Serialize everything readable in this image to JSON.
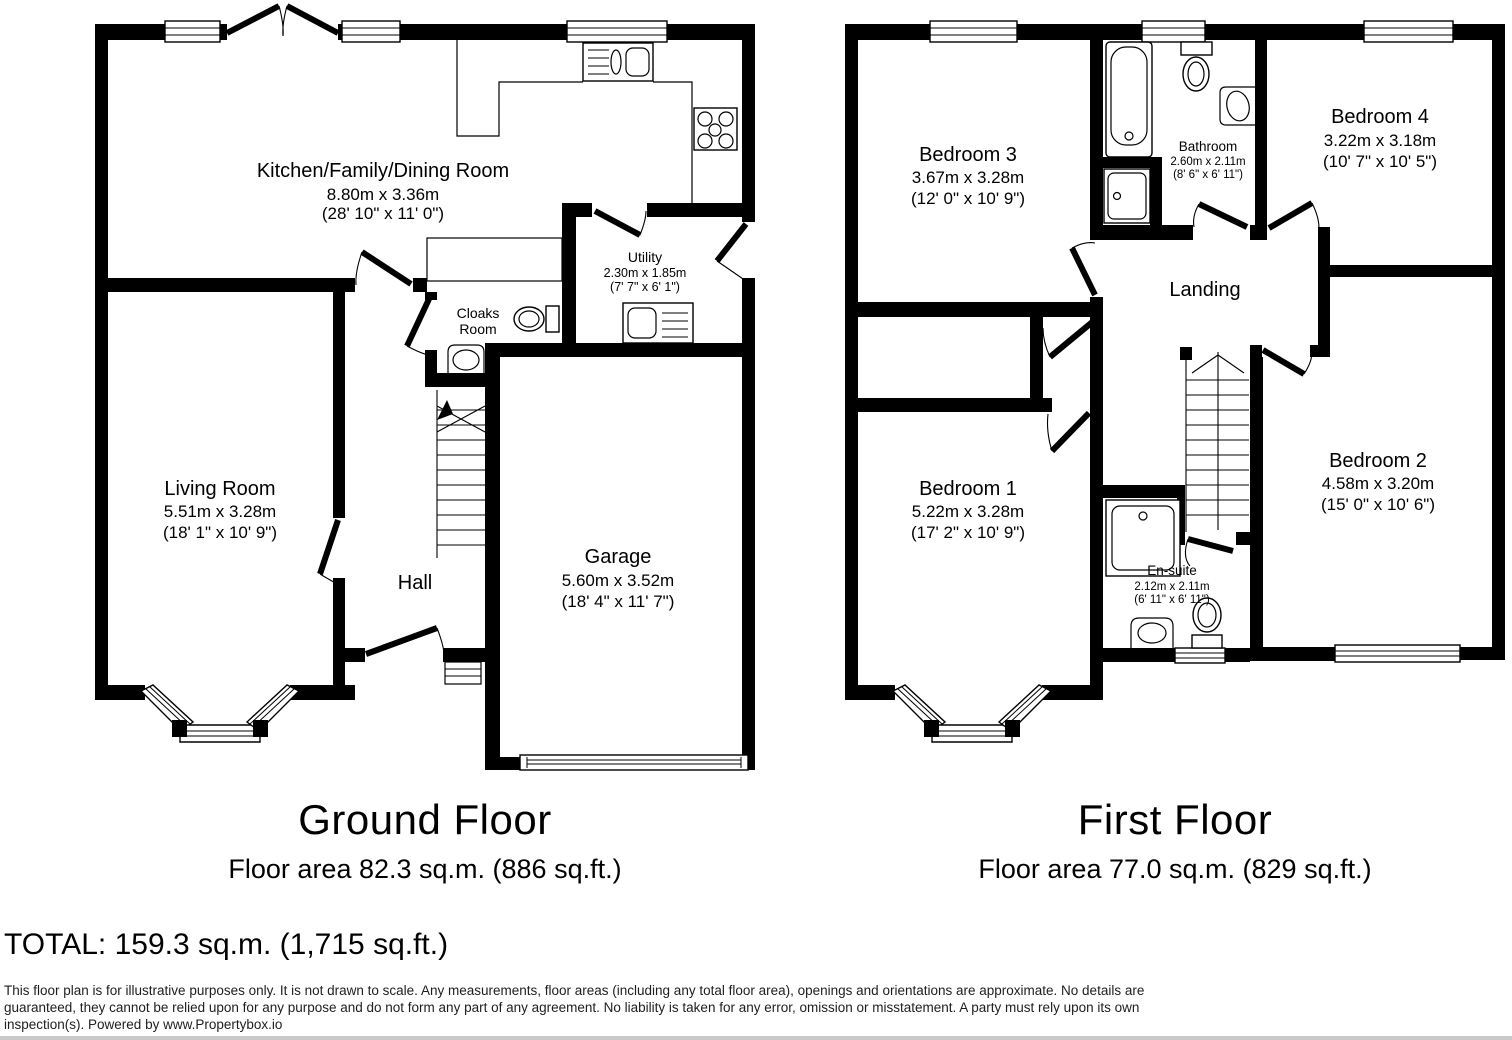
{
  "ground": {
    "title": "Ground Floor",
    "area": "Floor area 82.3 sq.m. (886 sq.ft.)",
    "rooms": {
      "kitchen": {
        "name": "Kitchen/Family/Dining Room",
        "metric": "8.80m x 3.36m",
        "imperial": "(28' 10\" x 11' 0\")"
      },
      "living": {
        "name": "Living Room",
        "metric": "5.51m x 3.28m",
        "imperial": "(18' 1\" x 10' 9\")"
      },
      "hall": {
        "name": "Hall"
      },
      "garage": {
        "name": "Garage",
        "metric": "5.60m x 3.52m",
        "imperial": "(18' 4\" x 11' 7\")"
      },
      "utility": {
        "name": "Utility",
        "metric": "2.30m x 1.85m",
        "imperial": "(7' 7\" x 6' 1\")"
      },
      "cloaks": {
        "line1": "Cloaks",
        "line2": "Room"
      }
    }
  },
  "first": {
    "title": "First Floor",
    "area": "Floor area 77.0 sq.m. (829 sq.ft.)",
    "rooms": {
      "bed1": {
        "name": "Bedroom 1",
        "metric": "5.22m x 3.28m",
        "imperial": "(17' 2\" x 10' 9\")"
      },
      "bed2": {
        "name": "Bedroom 2",
        "metric": "4.58m x 3.20m",
        "imperial": "(15' 0\" x 10' 6\")"
      },
      "bed3": {
        "name": "Bedroom 3",
        "metric": "3.67m x 3.28m",
        "imperial": "(12' 0\" x 10' 9\")"
      },
      "bed4": {
        "name": "Bedroom 4",
        "metric": "3.22m x 3.18m",
        "imperial": "(10' 7\" x 10' 5\")"
      },
      "bathroom": {
        "name": "Bathroom",
        "metric": "2.60m x 2.11m",
        "imperial": "(8' 6\" x 6' 11\")"
      },
      "ensuite": {
        "name": "En-suite",
        "metric": "2.12m x 2.11m",
        "imperial": "(6' 11\" x 6' 11\")"
      },
      "landing": {
        "name": "Landing"
      }
    }
  },
  "total": "TOTAL: 159.3 sq.m. (1,715 sq.ft.)",
  "disclaimer": "This floor plan is for illustrative purposes only. It is not drawn to scale. Any measurements, floor areas (including any total floor area), openings and orientations are approximate. No details are guaranteed, they cannot be relied upon for any purpose and do not form any part of any agreement. No liability is taken for any error, omission or misstatement. A party must rely upon its own inspection(s). Powered by www.Propertybox.io"
}
